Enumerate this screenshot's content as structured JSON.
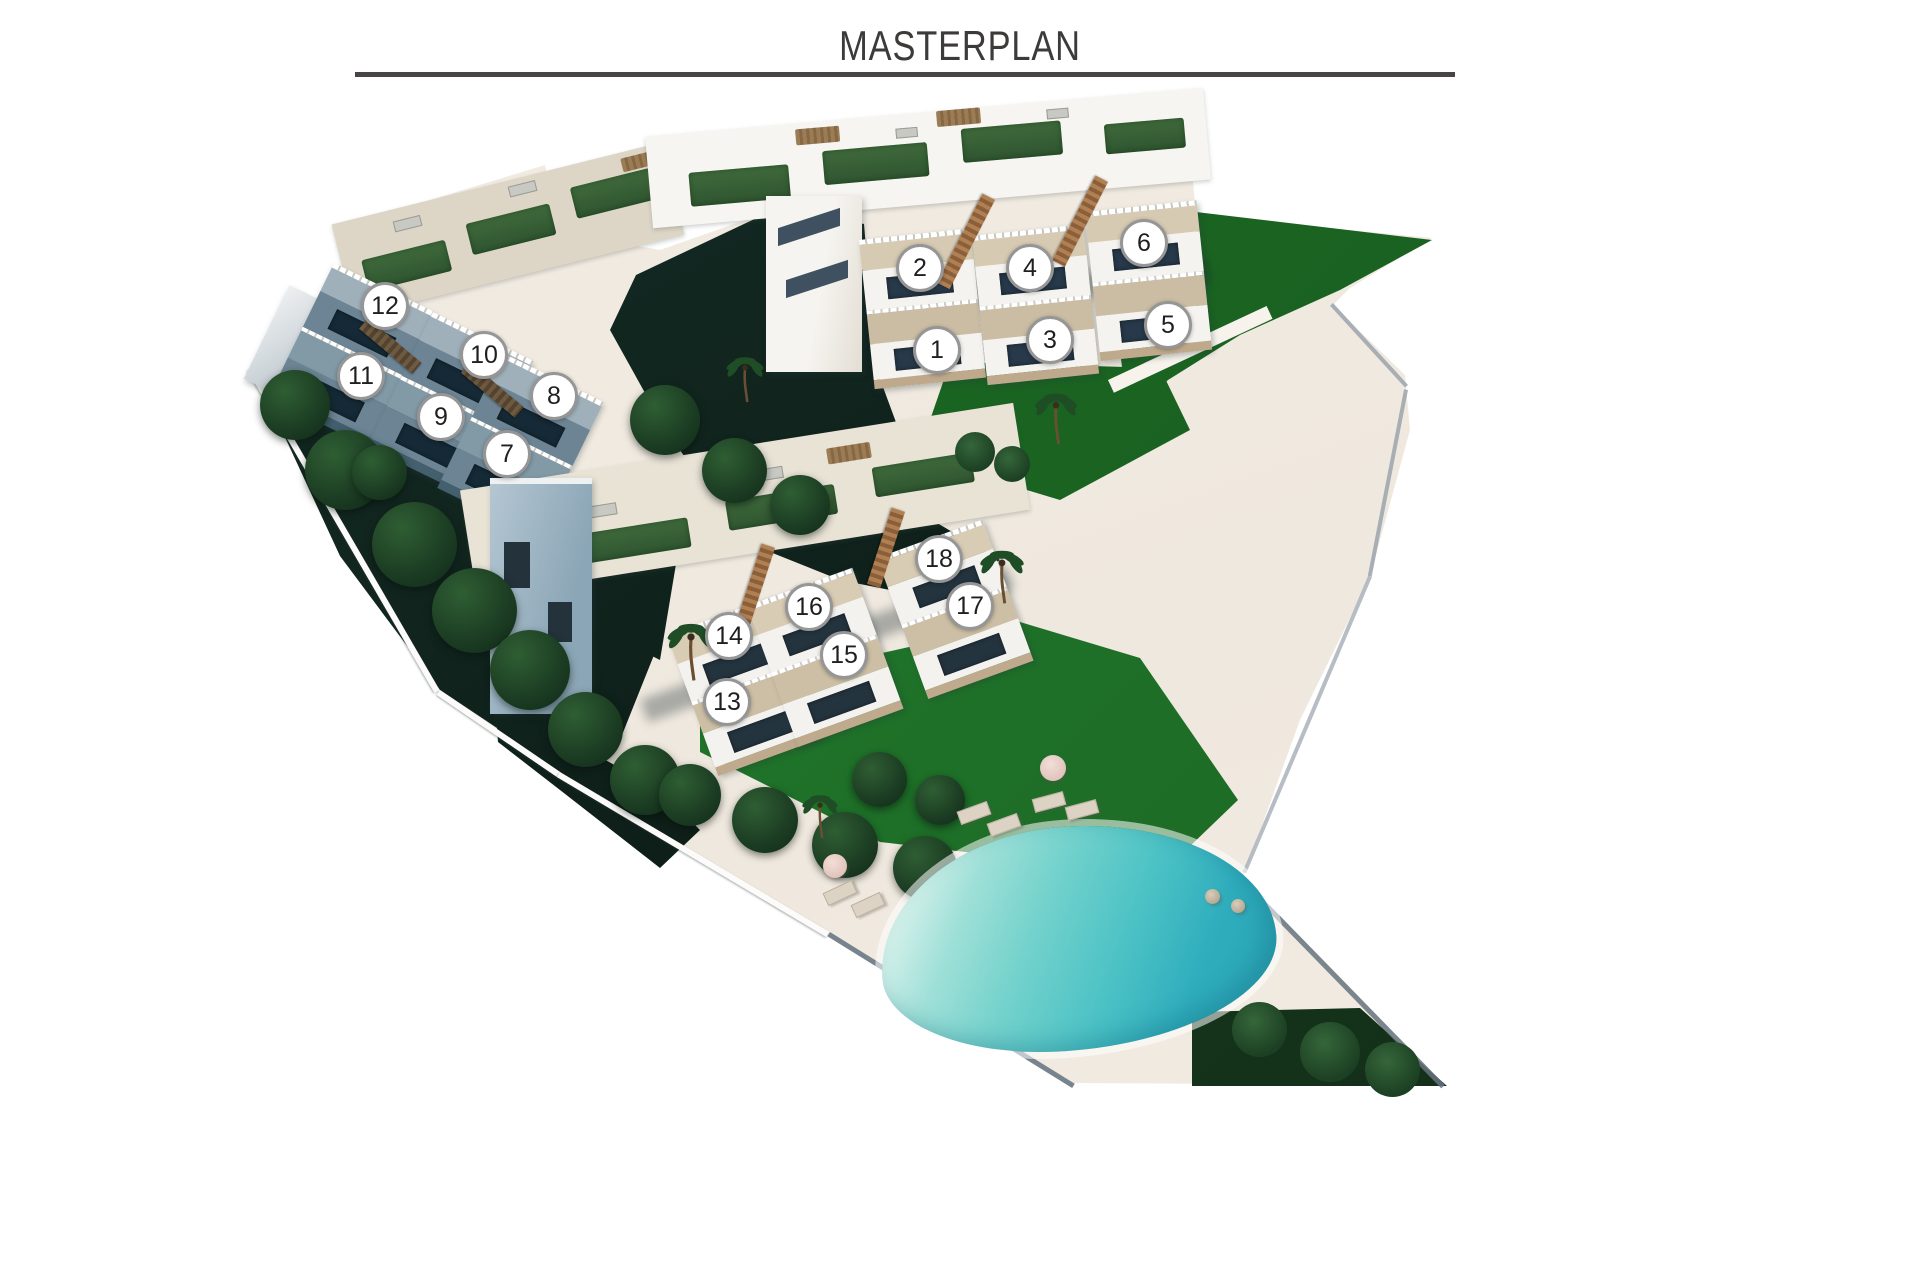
{
  "title": "MASTERPLAN",
  "markers": [
    {
      "number": "1",
      "x": 934,
      "y": 347
    },
    {
      "number": "2",
      "x": 917,
      "y": 265
    },
    {
      "number": "3",
      "x": 1047,
      "y": 337
    },
    {
      "number": "4",
      "x": 1027,
      "y": 265
    },
    {
      "number": "5",
      "x": 1165,
      "y": 322
    },
    {
      "number": "6",
      "x": 1141,
      "y": 240
    },
    {
      "number": "7",
      "x": 504,
      "y": 451
    },
    {
      "number": "8",
      "x": 551,
      "y": 393
    },
    {
      "number": "9",
      "x": 438,
      "y": 414
    },
    {
      "number": "10",
      "x": 481,
      "y": 352
    },
    {
      "number": "11",
      "x": 358,
      "y": 373
    },
    {
      "number": "12",
      "x": 382,
      "y": 303
    },
    {
      "number": "13",
      "x": 724,
      "y": 699
    },
    {
      "number": "14",
      "x": 726,
      "y": 633
    },
    {
      "number": "15",
      "x": 841,
      "y": 652
    },
    {
      "number": "16",
      "x": 806,
      "y": 604
    },
    {
      "number": "17",
      "x": 967,
      "y": 603
    },
    {
      "number": "18",
      "x": 936,
      "y": 556
    }
  ],
  "colors": {
    "title_text": "#3d3a3a",
    "title_rule": "#4a4545",
    "terrain_cream": "#efe8de",
    "lawn_green": "#1e6f28",
    "garden_dark": "#0d1c16",
    "pool_light": "#d9f2ec",
    "pool_dark": "#28a2b4",
    "building_white": "#f5f3ef",
    "terrace_beige": "#d7cab2",
    "shaded_facade": "#6c8494",
    "marker_fill": "#ffffff",
    "marker_border": "#969696",
    "marker_number": "#1f1f1f"
  },
  "icons": {
    "unit_marker": "unit-marker",
    "palm": "palm-tree-icon",
    "tree": "tree-canopy-icon",
    "parasol": "parasol-icon",
    "lounger": "sun-lounger-icon"
  }
}
